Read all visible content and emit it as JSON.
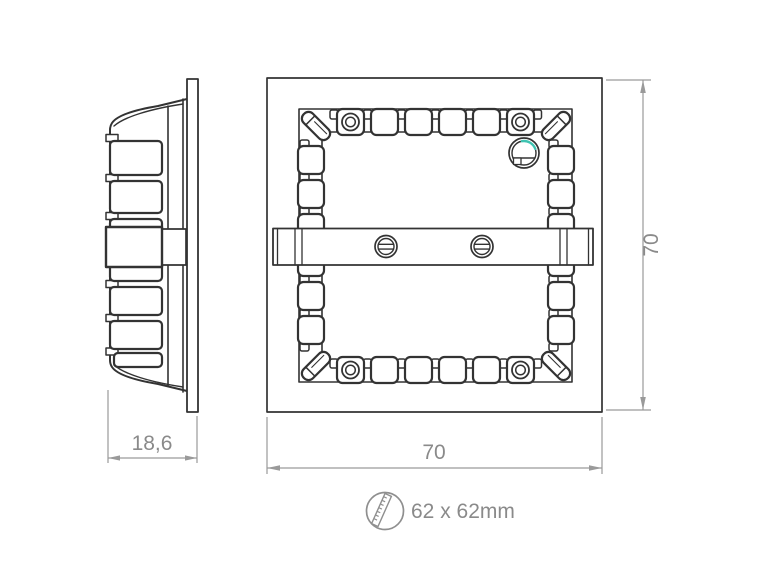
{
  "dimensions": {
    "side_depth": "18,6",
    "front_width": "70",
    "front_height": "70"
  },
  "cutout": {
    "icon": "ruler-icon",
    "label": "62 x 62mm"
  },
  "colors": {
    "background": "#ffffff",
    "drawing_line": "#333333",
    "dimension_line": "#9a9a9a",
    "dimension_text": "#8a8a8a",
    "accent": "#3ec3b1"
  }
}
